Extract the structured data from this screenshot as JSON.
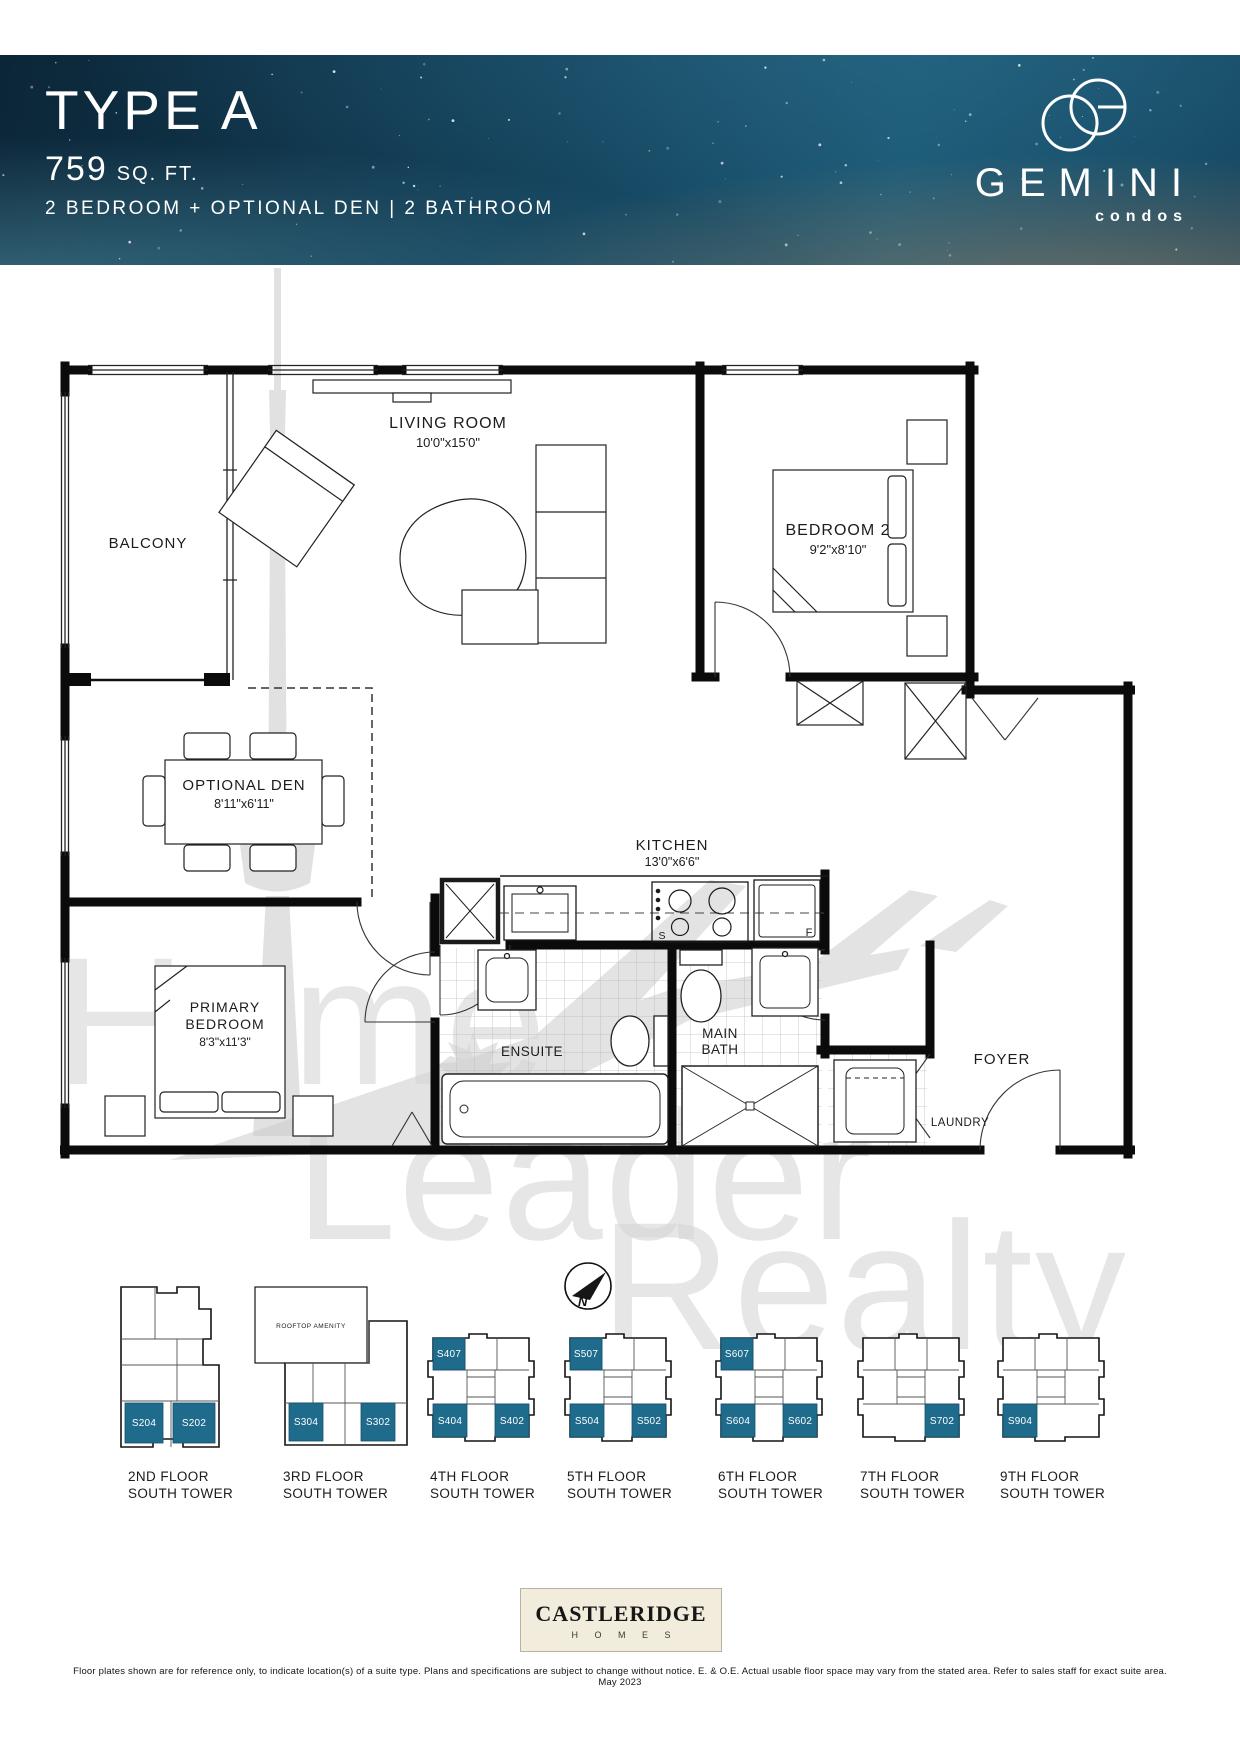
{
  "header": {
    "type_label": "TYPE A",
    "area_value": "759",
    "area_unit": "SQ. FT.",
    "config_line": "2 BEDROOM + OPTIONAL DEN  |  2 BATHROOM",
    "brand_name": "GEMINI",
    "brand_sub": "condos"
  },
  "floorplan": {
    "balcony": "BALCONY",
    "living_name": "LIVING ROOM",
    "living_dims": "10'0\"x15'0\"",
    "bedroom2_name": "BEDROOM 2",
    "bedroom2_dims": "9'2\"x8'10\"",
    "den_name": "OPTIONAL DEN",
    "den_dims": "8'11\"x6'11\"",
    "kitchen_name": "KITCHEN",
    "kitchen_dims": "13'0\"x6'6\"",
    "primary_name_line1": "PRIMARY",
    "primary_name_line2": "BEDROOM",
    "primary_dims": "8'3\"x11'3\"",
    "ensuite": "ENSUITE",
    "mainbath_line1": "MAIN",
    "mainbath_line2": "BATH",
    "foyer": "FOYER",
    "laundry": "LAUNDRY",
    "fridge_letter": "F",
    "stove_letter": "S",
    "north_letter": "N"
  },
  "keyplates": [
    {
      "floor": "2ND FLOOR",
      "tower": "SOUTH TOWER",
      "units": [
        {
          "id": "S204"
        },
        {
          "id": "S202"
        }
      ]
    },
    {
      "floor": "3RD FLOOR",
      "tower": "SOUTH TOWER",
      "amenity": "ROOFTOP AMENITY",
      "units": [
        {
          "id": "S304"
        },
        {
          "id": "S302"
        }
      ]
    },
    {
      "floor": "4TH FLOOR",
      "tower": "SOUTH TOWER",
      "units": [
        {
          "id": "S407"
        },
        {
          "id": "S404"
        },
        {
          "id": "S402"
        }
      ]
    },
    {
      "floor": "5TH FLOOR",
      "tower": "SOUTH TOWER",
      "units": [
        {
          "id": "S507"
        },
        {
          "id": "S504"
        },
        {
          "id": "S502"
        }
      ]
    },
    {
      "floor": "6TH FLOOR",
      "tower": "SOUTH TOWER",
      "units": [
        {
          "id": "S607"
        },
        {
          "id": "S604"
        },
        {
          "id": "S602"
        }
      ]
    },
    {
      "floor": "7TH FLOOR",
      "tower": "SOUTH TOWER",
      "units": [
        {
          "id": "S702"
        }
      ]
    },
    {
      "floor": "9TH FLOOR",
      "tower": "SOUTH TOWER",
      "units": [
        {
          "id": "S904"
        }
      ]
    }
  ],
  "watermark": {
    "line1": "Home",
    "line2": "Leader",
    "line3": "Realty"
  },
  "footer": {
    "builder_name": "CASTLERIDGE",
    "builder_sub": "H O M E S",
    "disclaimer": "Floor plates shown are for reference only, to indicate location(s) of a suite type. Plans and specifications are subject to change without notice. E. & O.E. Actual usable floor space may vary from the stated area. Refer to sales staff for exact suite area. May 2023"
  },
  "colors": {
    "highlight": "#1f6b8c",
    "header_bg": "#123f58"
  }
}
